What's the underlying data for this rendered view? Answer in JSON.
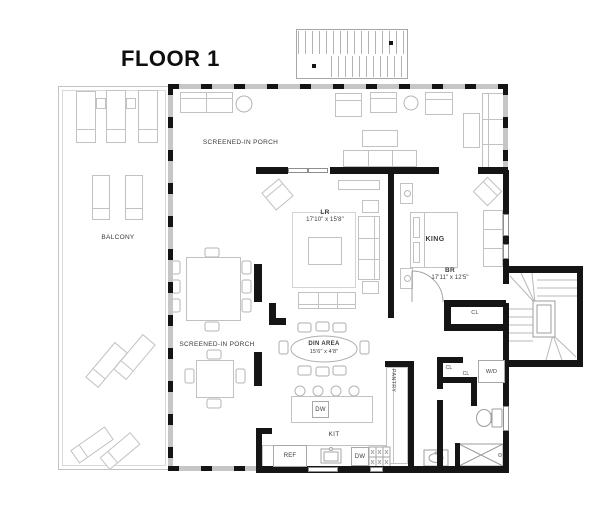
{
  "title": "FLOOR 1",
  "plan": {
    "rooms": {
      "porch_top": "SCREENED-IN PORCH",
      "porch_left": "SCREENED-IN PORCH",
      "balcony": "BALCONY",
      "living_room": {
        "abbr": "LR",
        "dims": "17'10\" x 15'8\""
      },
      "bedroom": {
        "abbr": "BR",
        "dims": "17'11\" x 12'5\"",
        "bed_label": "KING"
      },
      "dining": {
        "abbr": "DIN AREA",
        "dims": "15'6\" x 4'8\""
      },
      "kitchen": {
        "abbr": "KIT"
      },
      "pantry": {
        "abbr": "PANTRY"
      },
      "closet_bedroom": "CL",
      "closet_hall_1": "CL",
      "closet_hall_2": "CL",
      "laundry": "W/D"
    },
    "appliances": {
      "refrigerator": "REF",
      "dishwasher_island": "DW",
      "dishwasher_counter": "DW"
    },
    "colors": {
      "walls": "#151515",
      "furniture_outline": "#c2c2c2",
      "label_text": "#3a3a3a"
    }
  }
}
